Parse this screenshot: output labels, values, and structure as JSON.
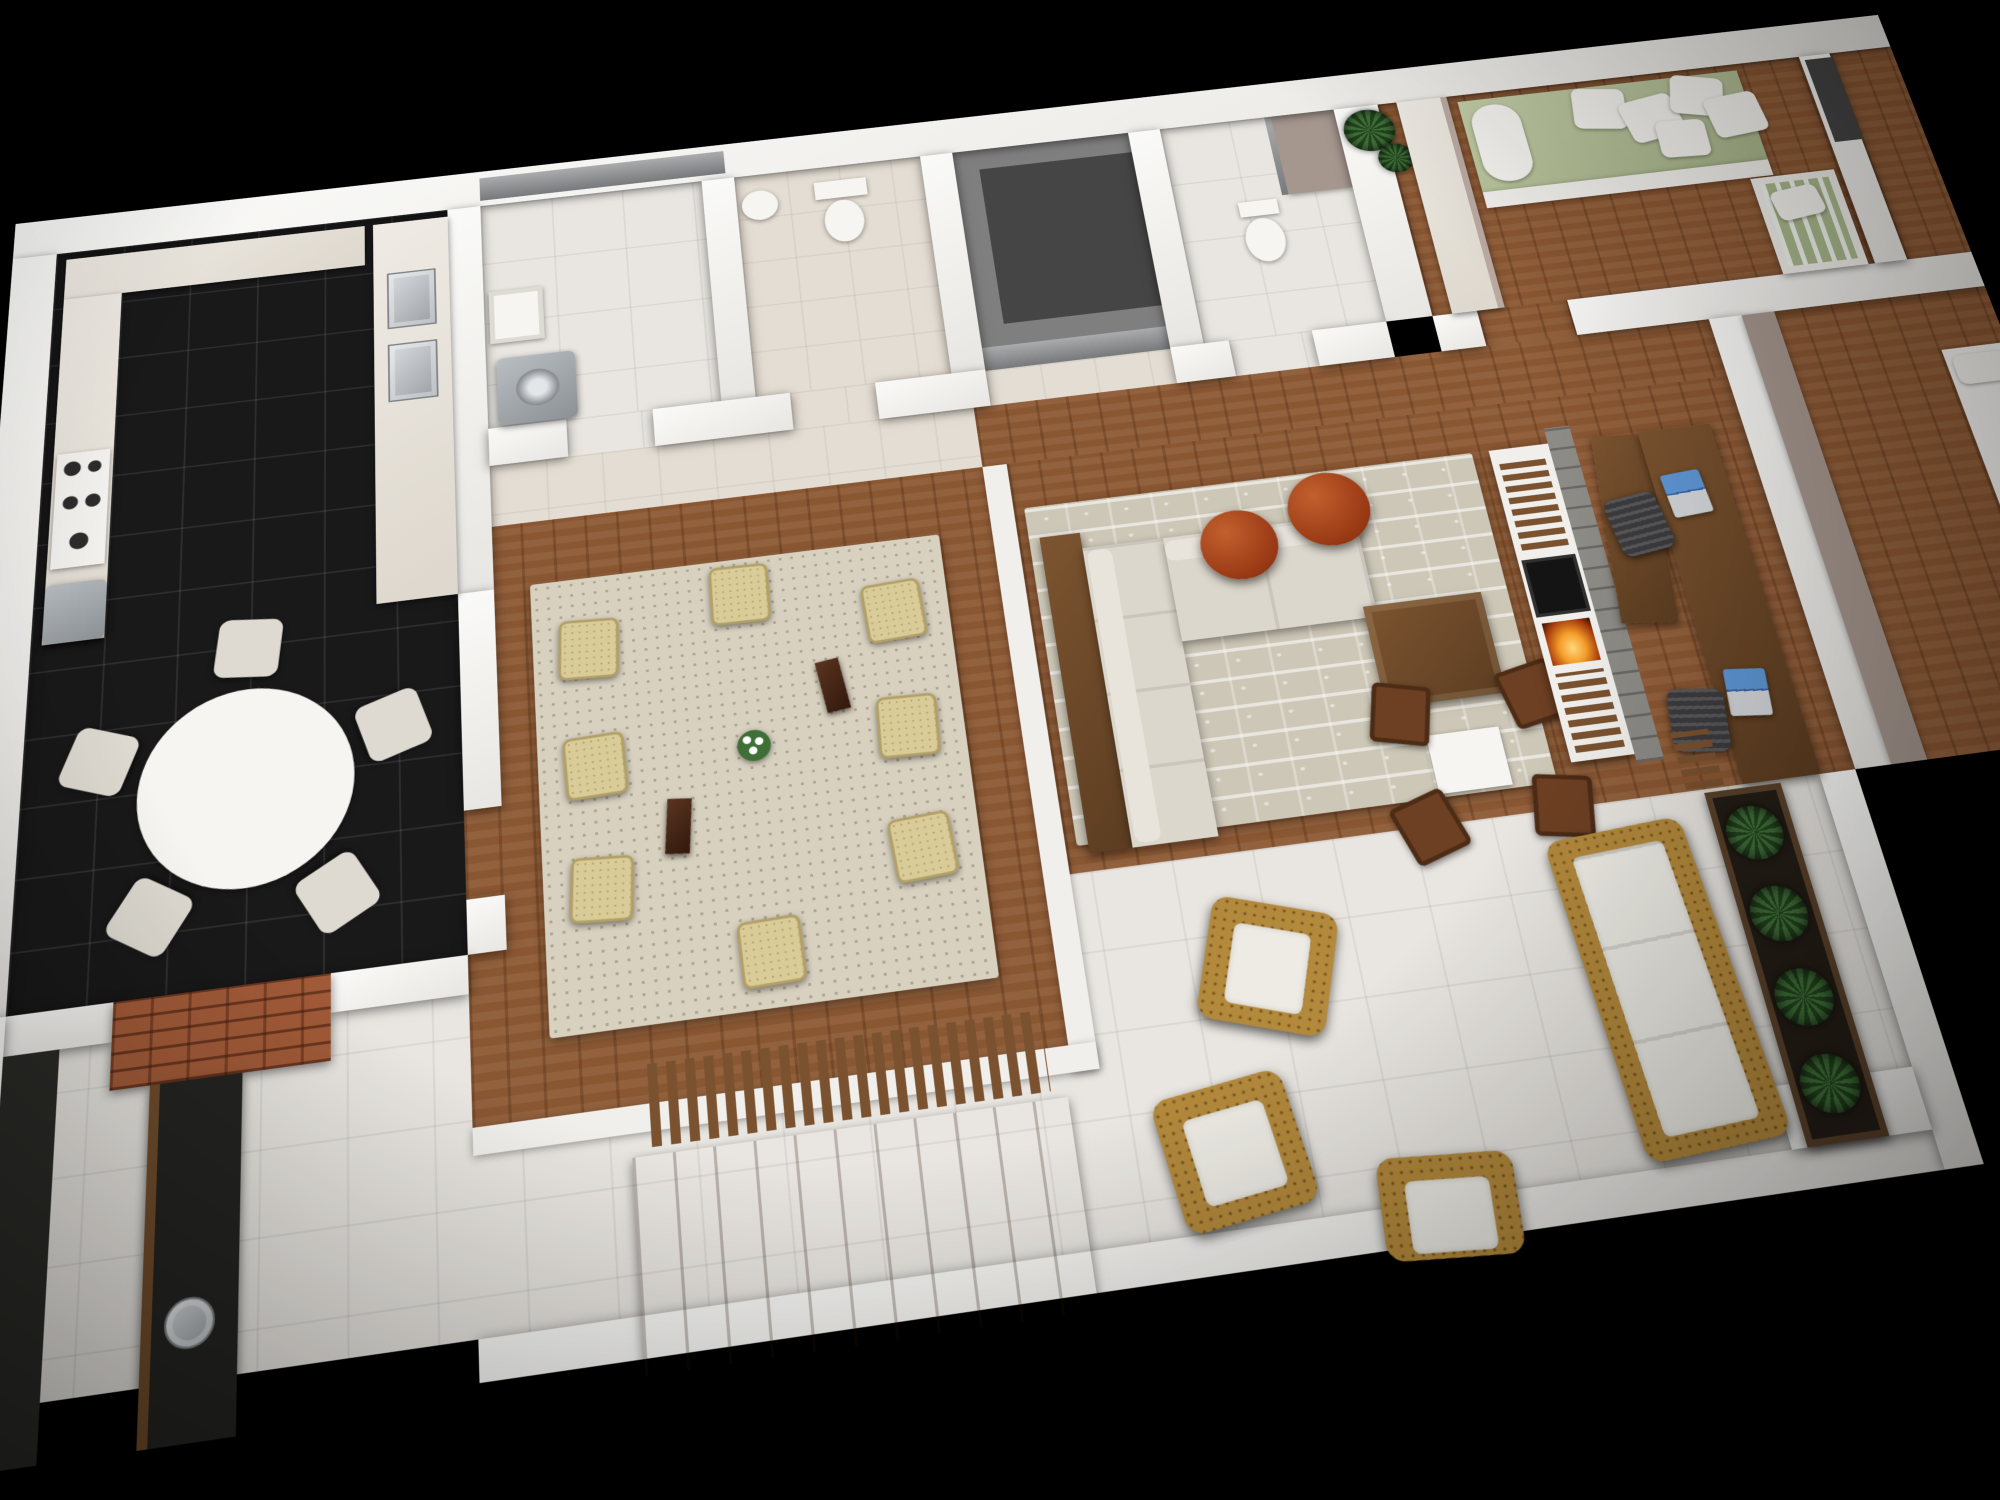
{
  "scene": {
    "type": "3d-floor-plan-render",
    "description": "Aerial three-quarter view 3D rendering of a furnished apartment floor plan on a black background",
    "background": "#000000",
    "projection": "elevated perspective, plan tilted with right wing toward upper right"
  },
  "palette": {
    "background": "#000000",
    "wall_white": "#f2f0ed",
    "wood_floor": "#8a5733",
    "black_tile": "#19191a",
    "white_tile": "#e9e6e1",
    "beige_tile": "#e4ddd3",
    "rug_beige": "#d8d1c0",
    "rug_living": "#cdc7b7",
    "sofa_cream": "#dcd7cd",
    "cane_chair": "#dacc98",
    "dark_wood_chair": "#6e4023",
    "pouf_rust": "#9a3a15",
    "brick": "#a05a38",
    "bbq_counter_dark": "#242422",
    "stainless_steel": "#b9bec2",
    "bed_green": "#b7c29c",
    "plant_green": "#3f7038",
    "flame_orange": "#f59d2a",
    "laptop_screen_blue": "#5e97d6",
    "taupe_accent": "#a5968e",
    "elevator_gray": "#7f7f7f",
    "wood_furniture": "#7c5430"
  },
  "rooms": {
    "kitchen": {
      "label": "Kitchen",
      "floor": "black ceramic tile",
      "furniture": [
        "back counter",
        "side counter",
        "gas cooktop with 5 burners",
        "oven front",
        "island counter",
        "double stainless-steel sinks with faucets"
      ]
    },
    "breakfast": {
      "label": "Breakfast nook",
      "floor": "black ceramic tile",
      "furniture": [
        "round white table",
        "5 cream chairs"
      ]
    },
    "laundry": {
      "label": "Laundry room",
      "floor": "white tile",
      "furniture": [
        "washing machine",
        "utility sink",
        "back window strip"
      ]
    },
    "powder": {
      "label": "Powder room",
      "floor": "beige tile",
      "furniture": [
        "corner washbasin",
        "toilet"
      ]
    },
    "elevator": {
      "label": "Elevator shaft",
      "floor": "concrete gray",
      "furniture": [
        "sliding doors"
      ]
    },
    "bathroom": {
      "label": "Bathroom",
      "floor": "white tile",
      "furniture": [
        "bidet",
        "shower enclosure with folding glass door"
      ]
    },
    "hallway": {
      "label": "Hallway",
      "floor": "wood parquet",
      "furniture": [
        "potted yucca plants"
      ]
    },
    "foyer": {
      "label": "Entry foyer",
      "floor": "beige tile",
      "furniture": []
    },
    "nursery": {
      "label": "Nursery bedroom",
      "floor": "wood parquet",
      "furniture": [
        "wardrobe unit",
        "single bed with green bedding",
        "bolster",
        "5 white pillows",
        "white baby crib with green mattress",
        "wall mirror"
      ]
    },
    "dining": {
      "label": "Dining room (raised wood platform)",
      "floor": "wood parquet over white fascia platform",
      "furniture": [
        "basketweave area rug",
        "8 cane dining chairs",
        "flower vase with white blooms",
        "2 dark wood candle pillars"
      ]
    },
    "living": {
      "label": "Living room",
      "floor": "wood parquet",
      "furniture": [
        "patterned area rug",
        "L-shaped cream sectional sofa with chaise",
        "wood console shelf",
        "2 rust leather poufs",
        "square wood coffee table",
        "white side table",
        "4 dark wood chairs",
        "media wall with TV and fireplace",
        "stone chimney strip"
      ]
    },
    "office": {
      "label": "Home office nook",
      "floor": "wood parquet",
      "furniture": [
        "wood partition panel",
        "long wooden desk",
        "2 laptops",
        "2 black office chairs",
        "slatted wood rack"
      ]
    },
    "bedrooms_right": {
      "label": "Bedrooms (cropped at right edge)",
      "floor": "wood parquet",
      "furniture": [
        "taupe accent walls",
        "white beds (partially visible)"
      ]
    },
    "terrace": {
      "label": "Terrace / barbecue area",
      "floor": "large white tile",
      "furniture": [
        "brick barbecue wall",
        "dark stone counter with round steel sink",
        "wooden outdoor table",
        "slatted wood bench",
        "3 wicker armchairs with white cushions",
        "wicker sofa with white cushions",
        "long planter box with yucca plants",
        "white parapet walls"
      ]
    }
  }
}
